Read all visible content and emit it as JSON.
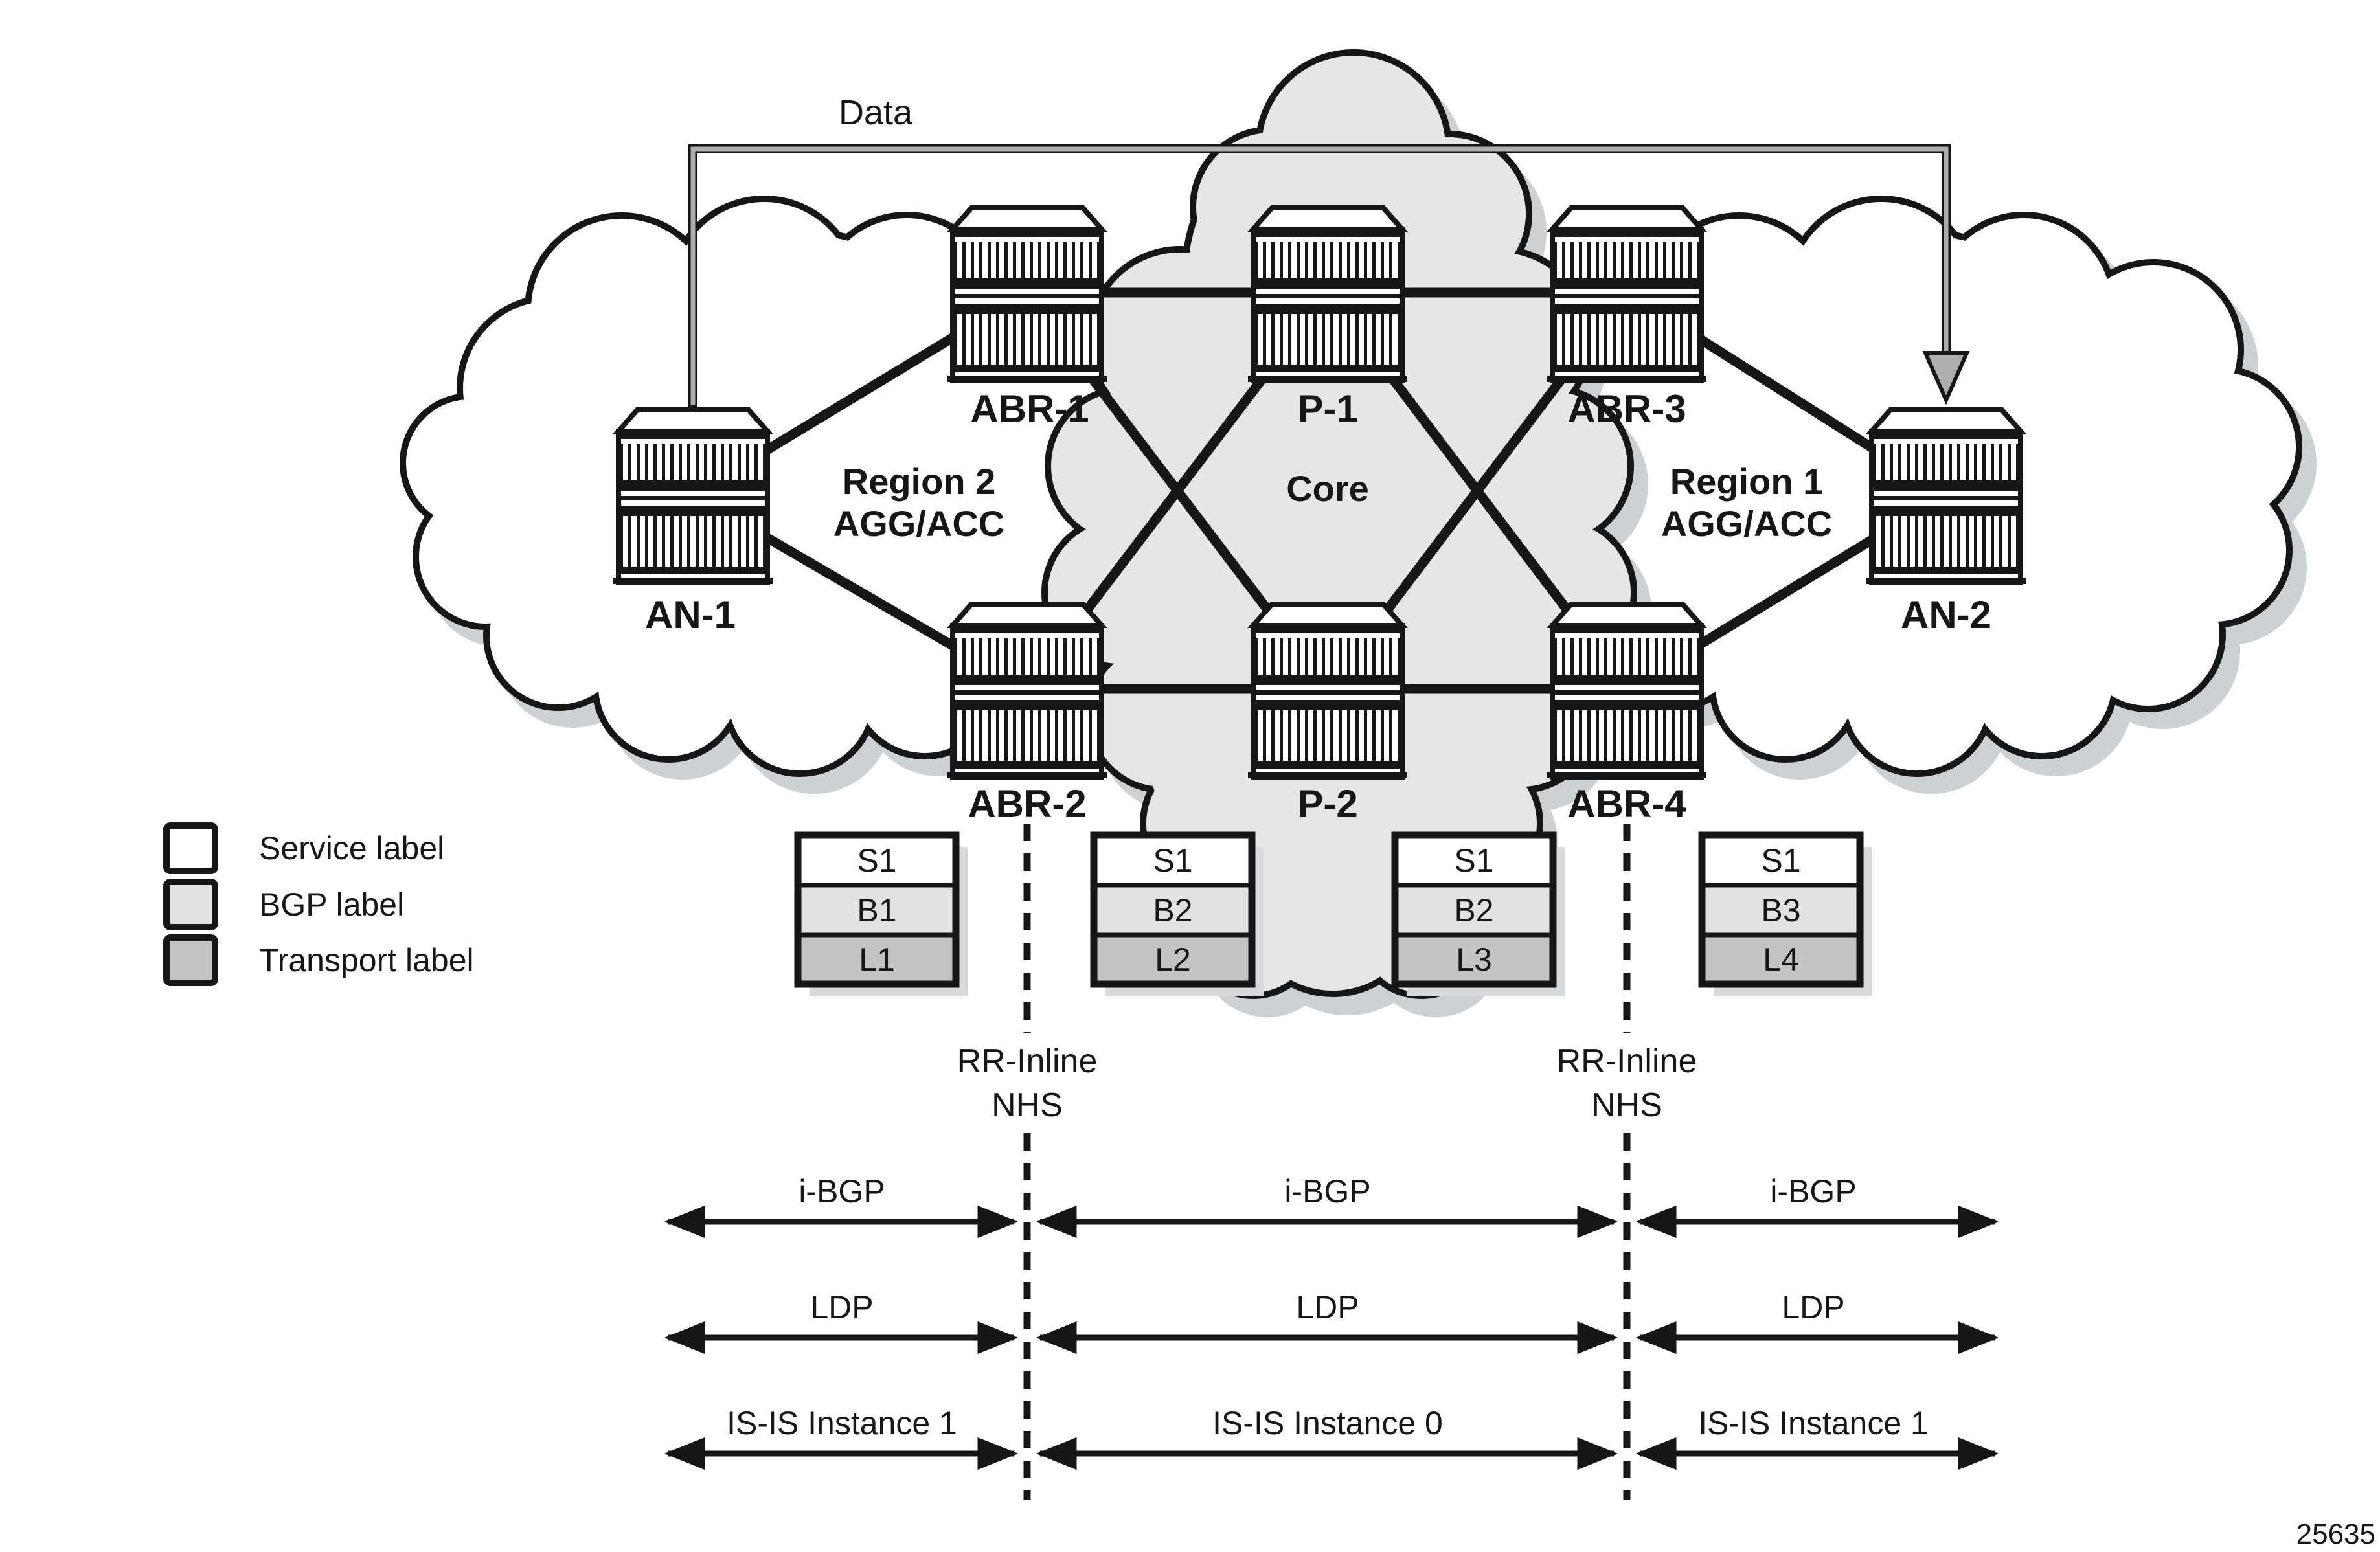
{
  "diagram": {
    "data_flow_label": "Data",
    "figure_number": "25635"
  },
  "nodes": {
    "an1": "AN-1",
    "an2": "AN-2",
    "abr1": "ABR-1",
    "abr2": "ABR-2",
    "abr3": "ABR-3",
    "abr4": "ABR-4",
    "p1": "P-1",
    "p2": "P-2"
  },
  "regions": {
    "region2": {
      "line1": "Region 2",
      "line2": "AGG/ACC"
    },
    "core": {
      "label": "Core"
    },
    "region1": {
      "line1": "Region 1",
      "line2": "AGG/ACC"
    }
  },
  "legend": {
    "items": [
      {
        "label": "Service label",
        "color": "#ffffff"
      },
      {
        "label": "BGP label",
        "color": "#e2e2e2"
      },
      {
        "label": "Transport label",
        "color": "#c3c3c3"
      }
    ]
  },
  "stacks": [
    {
      "cells": [
        "S1",
        "B1",
        "L1"
      ]
    },
    {
      "cells": [
        "S1",
        "B2",
        "L2"
      ]
    },
    {
      "cells": [
        "S1",
        "B2",
        "L3"
      ]
    },
    {
      "cells": [
        "S1",
        "B3",
        "L4"
      ]
    }
  ],
  "rr_annotations": [
    {
      "line1": "RR-Inline",
      "line2": "NHS"
    },
    {
      "line1": "RR-Inline",
      "line2": "NHS"
    }
  ],
  "protocols": [
    {
      "name": "i-BGP",
      "segments": [
        "i-BGP",
        "i-BGP",
        "i-BGP"
      ]
    },
    {
      "name": "LDP",
      "segments": [
        "LDP",
        "LDP",
        "LDP"
      ]
    },
    {
      "name": "IS-IS",
      "segments": [
        "IS-IS Instance 1",
        "IS-IS Instance 0",
        "IS-IS Instance 1"
      ]
    }
  ],
  "colors": {
    "ink": "#161616",
    "service_label": "#ffffff",
    "bgp_label": "#e2e2e2",
    "transport_label": "#c3c3c3",
    "region_cloud_fill": "#ffffff",
    "core_cloud_fill": "#e6e6e7",
    "shadow": "#ced1d3",
    "data_arrow_gray": "#aeaeae"
  }
}
